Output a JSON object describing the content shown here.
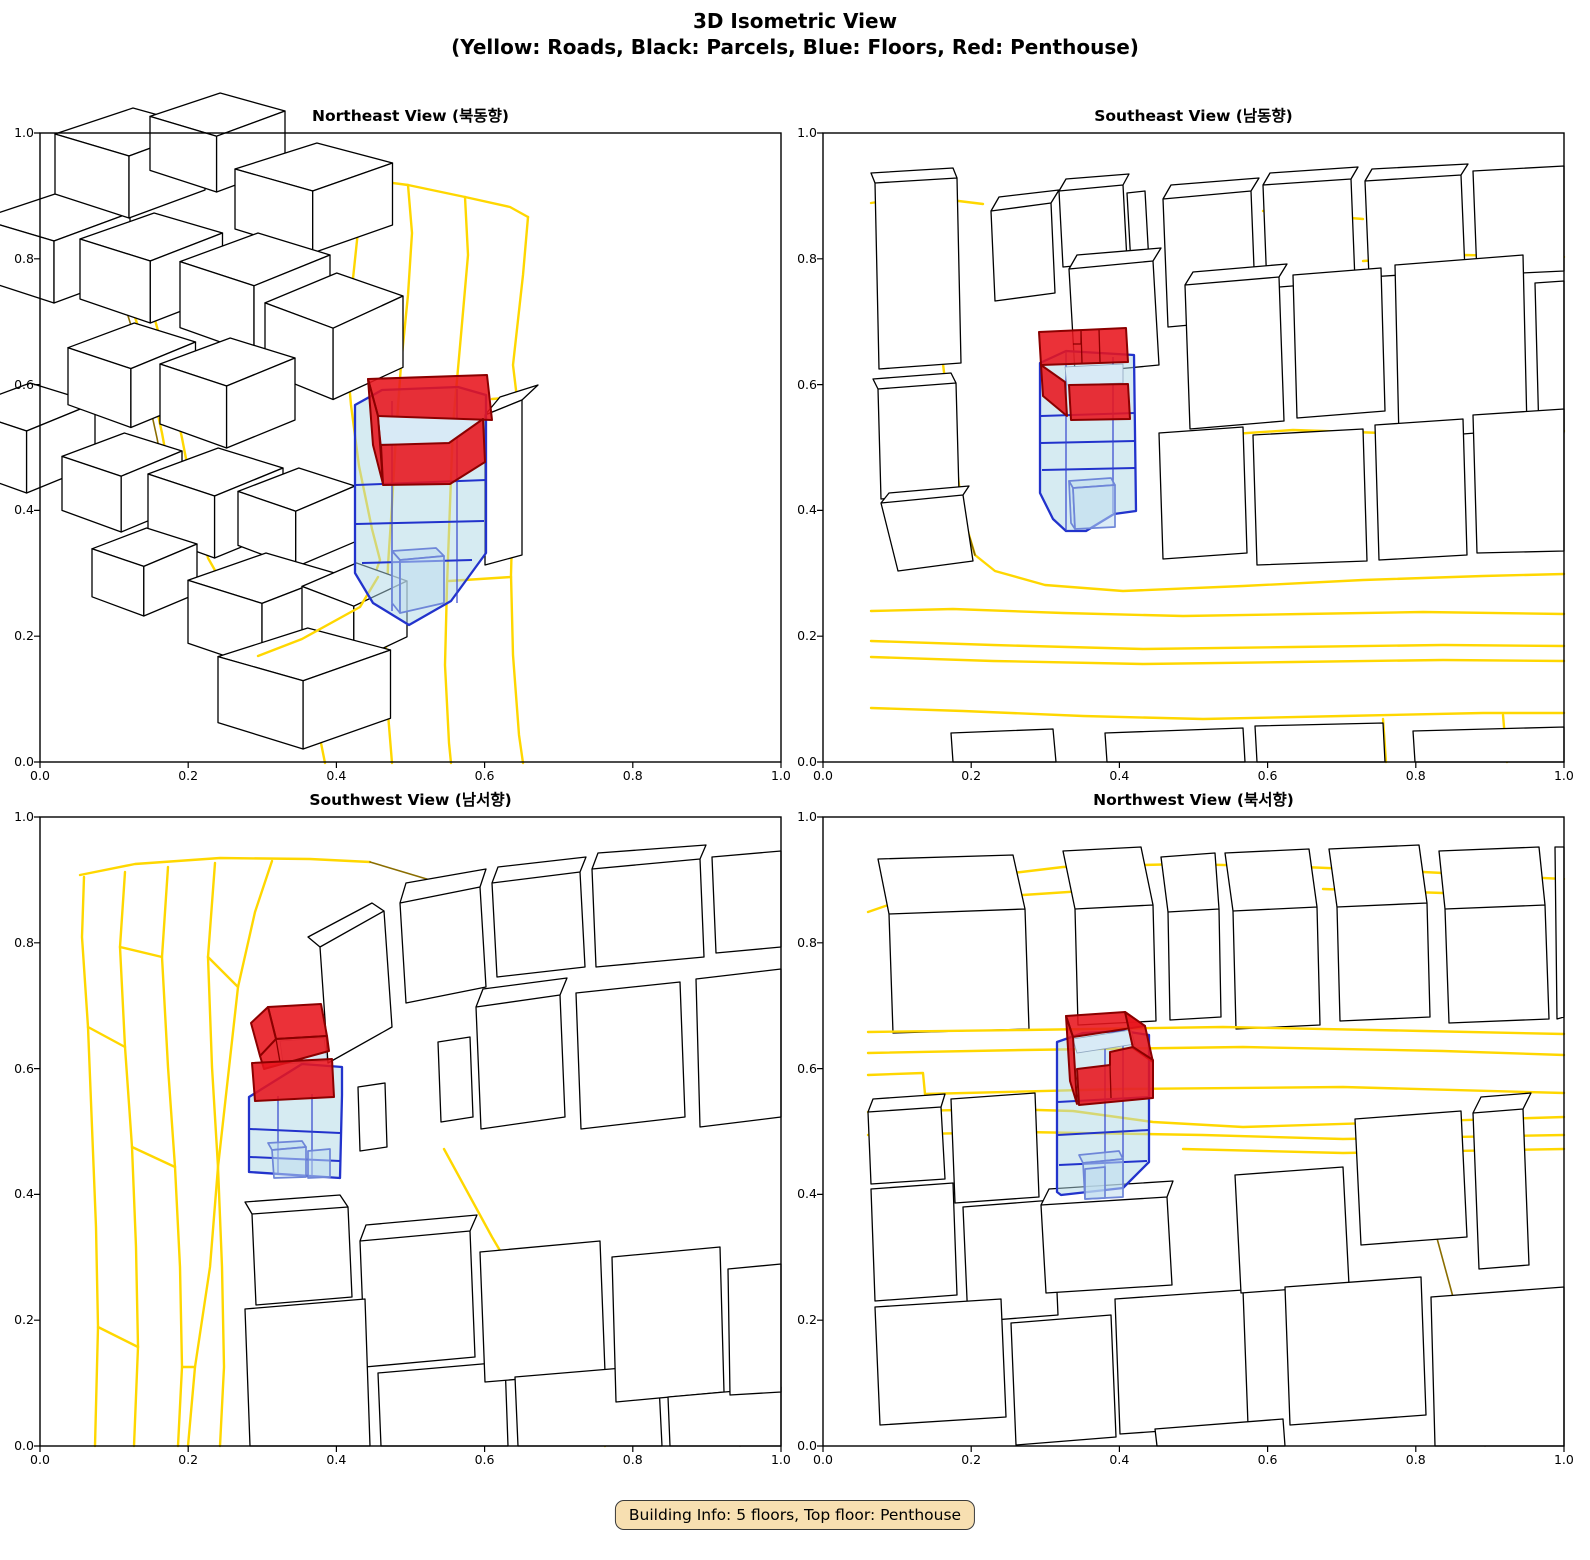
{
  "figure": {
    "title_line1": "3D Isometric View",
    "title_line2": "(Yellow: Roads, Black: Parcels, Blue: Floors, Red: Penthouse)"
  },
  "subplots": [
    {
      "title": "Northeast View (북동향)"
    },
    {
      "title": "Southeast View (남동향)"
    },
    {
      "title": "Southwest View (남서향)"
    },
    {
      "title": "Northwest View (북서향)"
    }
  ],
  "axes": {
    "x_ticks": [
      "0.0",
      "0.2",
      "0.4",
      "0.6",
      "0.8",
      "1.0"
    ],
    "y_ticks": [
      "0.0",
      "0.2",
      "0.4",
      "0.6",
      "0.8",
      "1.0"
    ],
    "x_range": [
      0.0,
      1.0
    ],
    "y_range": [
      0.0,
      1.0
    ]
  },
  "legend": {
    "roads_color": "#FFD700",
    "parcels_color": "#000000",
    "floors_color": "#ADD8E6",
    "penthouse_color": "#E8151D"
  },
  "badge": {
    "text": "Building Info: 5 floors, Top floor: Penthouse"
  },
  "building": {
    "floors": "5",
    "top_floor": "Penthouse"
  }
}
